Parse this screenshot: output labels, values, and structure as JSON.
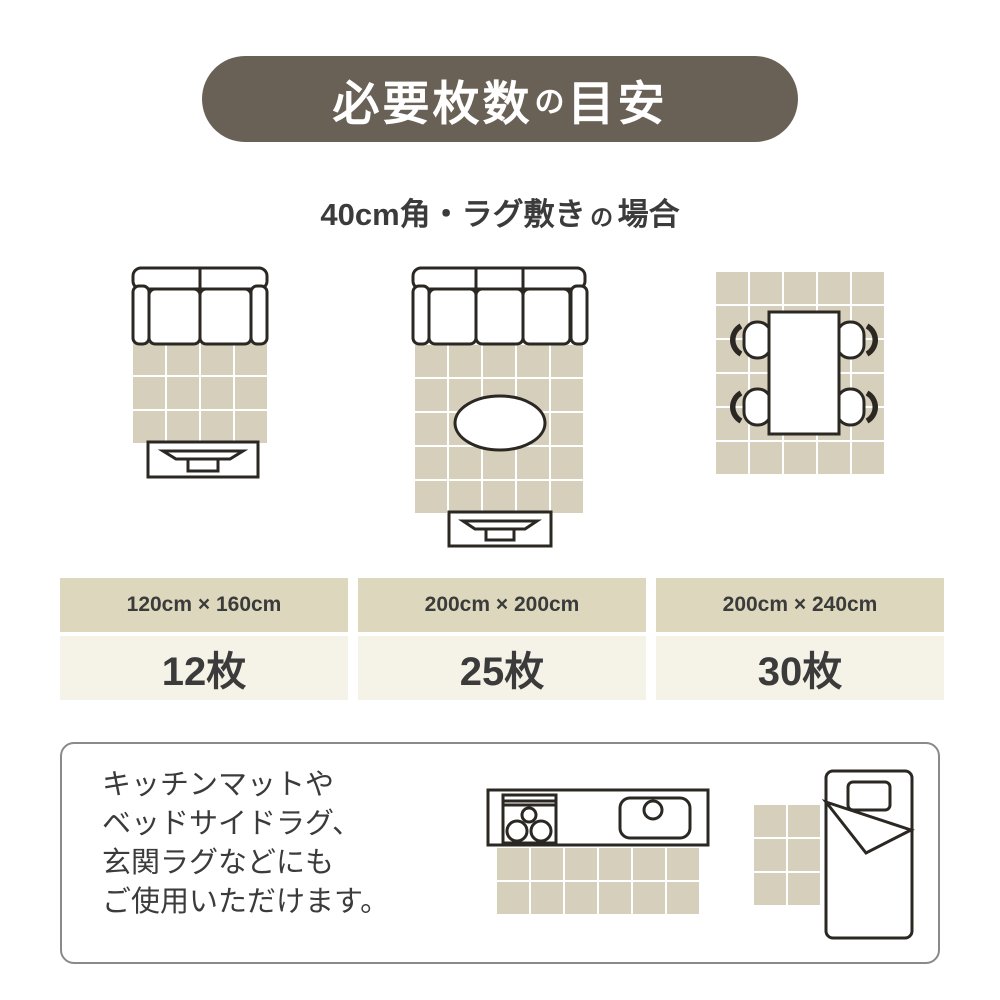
{
  "colors": {
    "page_bg": "#ffffff",
    "pill": "#6a6156",
    "pill_text": "#ffffff",
    "tile": "#d6cfbc",
    "band_top": "#ddd8bd",
    "band_bottom": "#f5f3e7",
    "line": "#2b2722",
    "text": "#3b3b3b",
    "box_border": "#8a8a8a"
  },
  "header": {
    "title_parts": [
      "必要枚数",
      "の",
      "目安"
    ],
    "subtitle_parts": [
      "40cm角・ラグ敷き",
      "の",
      "場合"
    ]
  },
  "layouts": {
    "living_small": {
      "label": "2-seat sofa with rug",
      "grid": {
        "cols": 4,
        "rows": 3,
        "x": 6,
        "y": 77,
        "tile": 32,
        "gap": 2
      }
    },
    "living_large": {
      "label": "3-seat sofa with rug and table",
      "grid": {
        "cols": 5,
        "rows": 5,
        "x": 4,
        "y": 79,
        "tile": 32,
        "gap": 2
      }
    },
    "dining": {
      "label": "dining table with chairs",
      "grid": {
        "cols": 5,
        "rows": 6,
        "x": 2,
        "y": 2,
        "tile": 32,
        "gap": 2
      }
    },
    "kitchen": {
      "label": "kitchen mat",
      "grid": {
        "cols": 6,
        "rows": 2,
        "x": 11,
        "y": 60,
        "tile": 32,
        "gap": 2
      }
    },
    "bedside": {
      "label": "bedside rug",
      "grid": {
        "cols": 2,
        "rows": 3,
        "x": 0,
        "y": 36,
        "tile": 32,
        "gap": 2
      }
    }
  },
  "cards": [
    {
      "size": "120cm × 160cm",
      "count": "12枚"
    },
    {
      "size": "200cm × 200cm",
      "count": "25枚"
    },
    {
      "size": "200cm × 240cm",
      "count": "30枚"
    }
  ],
  "note": {
    "lines": [
      "キッチンマットや",
      "ベッドサイドラグ、",
      "玄関ラグなどにも",
      "ご使用いただけます。"
    ]
  }
}
